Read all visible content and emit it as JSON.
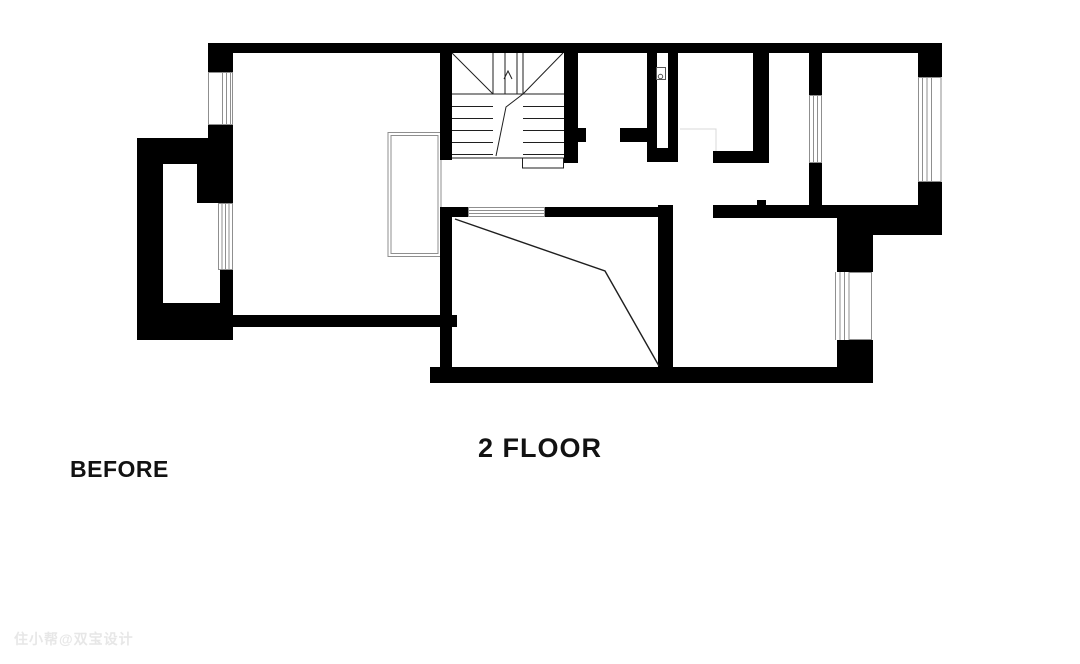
{
  "page": {
    "kind": "architectural-floor-plan",
    "background": "#ffffff"
  },
  "labels": {
    "floor_title": "2 FLOOR",
    "stage_label": "BEFORE",
    "watermark": "住小帮@双宝设计"
  },
  "colors": {
    "bg": "#ffffff",
    "wall": "#000000",
    "window_line": "#8f8f8f",
    "void_line": "#8f8f8f",
    "annot": "#1f1f1f",
    "faint_line": "#d8d8d8",
    "text": "#121212",
    "watermark": "#e7e7e7"
  },
  "symbols": [
    {
      "name": "staircase-symbol",
      "description": "U-shaped stair with two flights, winder diagonals and break line"
    },
    {
      "name": "void-railing-symbol",
      "description": "double-line open well beside stair left wall"
    },
    {
      "name": "window-symbol",
      "description": "multi-line glazing strips on exterior and interior walls"
    },
    {
      "name": "duct-symbol",
      "description": "small box with circle inside shaft"
    },
    {
      "name": "slope-annotation",
      "description": "polyline across lower-middle room"
    }
  ]
}
